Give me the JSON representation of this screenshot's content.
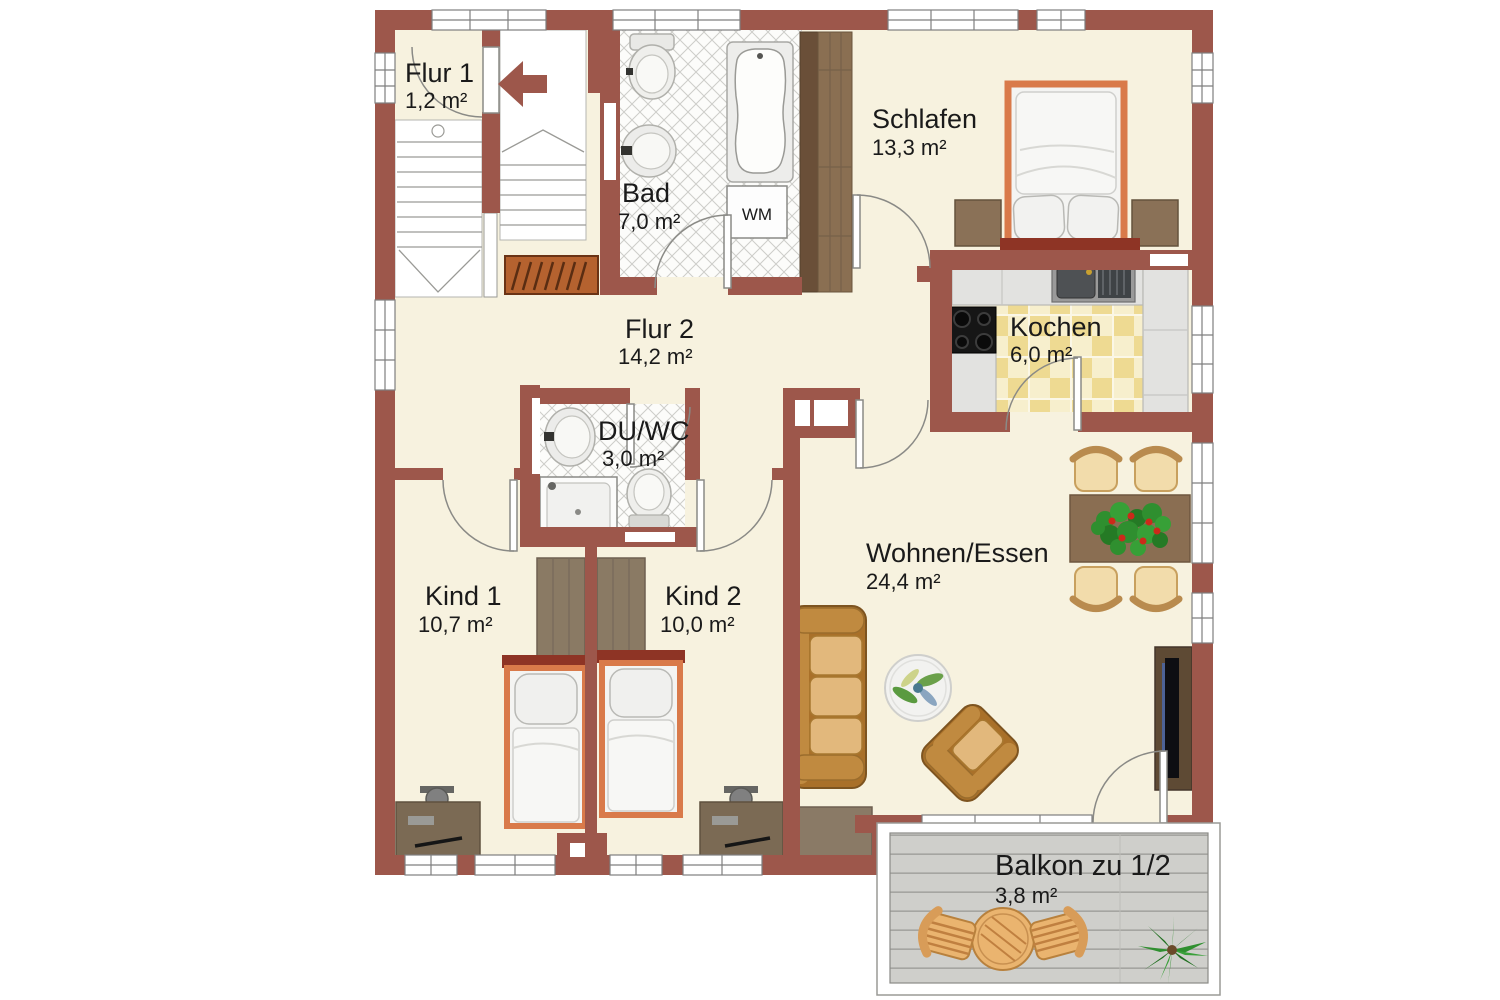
{
  "plan": {
    "type": "apartment floor plan",
    "rooms": [
      {
        "name": "Flur 1",
        "area": "1,2 m²"
      },
      {
        "name": "Bad",
        "area": "7,0 m²"
      },
      {
        "name": "Schlafen",
        "area": "13,3 m²"
      },
      {
        "name": "Kochen",
        "area": "6,0 m²"
      },
      {
        "name": "Flur 2",
        "area": "14,2 m²"
      },
      {
        "name": "DU/WC",
        "area": "3,0 m²"
      },
      {
        "name": "Kind 1",
        "area": "10,7 m²"
      },
      {
        "name": "Kind 2",
        "area": "10,0 m²"
      },
      {
        "name": "Wohnen/Essen",
        "area": "24,4 m²"
      },
      {
        "name": "Balkon zu 1/2",
        "area": "3,8 m²"
      }
    ],
    "appliances": {
      "washing_machine": "WM"
    },
    "palette": {
      "wall": "#9d574b",
      "floor": "#f7f2df",
      "bath_tile": "#fcfcfa",
      "tile_line": "#cdcdc9",
      "kitchen_tile_a": "#eeda92",
      "kitchen_tile_b": "#f7efcd",
      "counter": "#e2e2e0",
      "stove": "#161616",
      "wood_dark": "#6a4f38",
      "wood_mid": "#8a7a64",
      "bed_frame": "#d97a4a",
      "bed_headboard": "#8e3425",
      "bedding": "#f4f4f2",
      "leather": "#c08a40",
      "leather_cushion": "#e2b87c",
      "chair_seat": "#f2dcab",
      "deck": "#cfcfcb",
      "plant_green": "#2f8f2f",
      "plant_red": "#cc2a1a",
      "tv": "#0e0e12",
      "door_line": "#8a8a86"
    }
  }
}
